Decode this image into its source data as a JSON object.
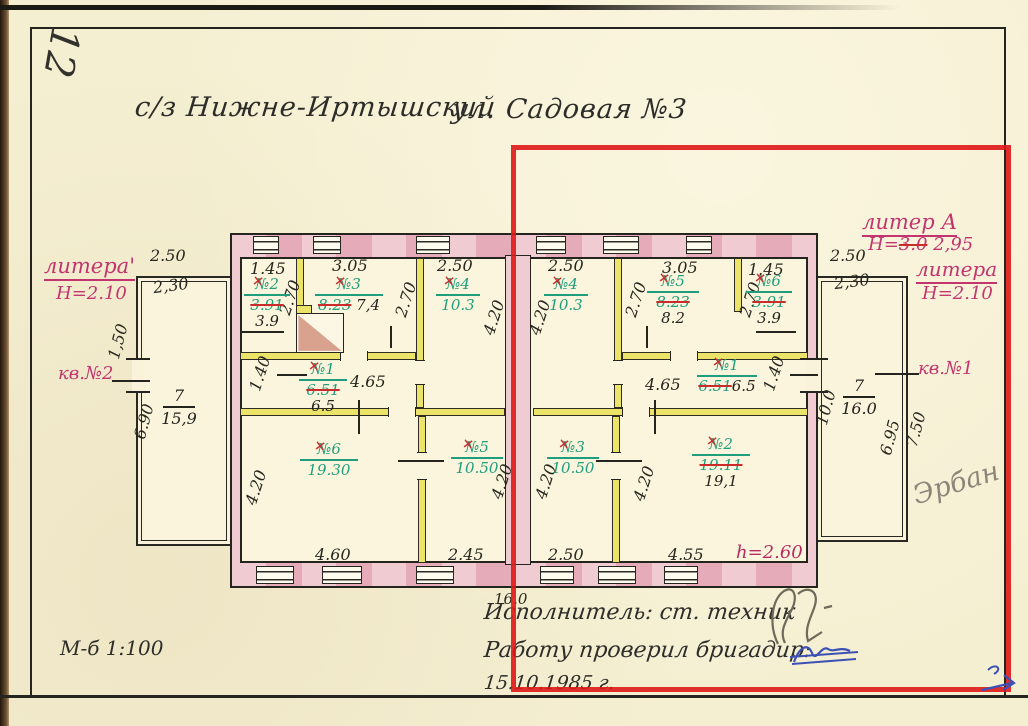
{
  "page": {
    "corner_number": "12",
    "title": "с/з Нижне-Иртышский",
    "title_street": "ул. Садовая №3",
    "scale": "М-б 1:100"
  },
  "left_wing": {
    "litera": "литера'",
    "height": "Н=2.10",
    "apartment": "кв.№2",
    "dim_top": "2.50",
    "dim_top_inner": "2,30",
    "dim_door": "1,50",
    "dim_side": "6.90",
    "room": {
      "no": "7",
      "area": "15,9"
    }
  },
  "right_wing": {
    "liter_a": "литер А",
    "liter_a_h_prefix": "Н=",
    "liter_a_h_old": "3.0",
    "liter_a_h_new": "2,95",
    "litera": "литера",
    "height": "Н=2.10",
    "apartment": "кв.№1",
    "dim_top": "2.50",
    "dim_top_inner": "2,30",
    "dim_side": "10.0",
    "dim_inner": "6.95",
    "dim_outer": "7.50",
    "room": {
      "no": "7",
      "area": "16.0"
    },
    "pencil_note": "Эрбан"
  },
  "building": {
    "dim_total": "16.0",
    "height_note": "h=2.60",
    "top_dims": [
      "1.45",
      "3.05",
      "2.50",
      "2.50",
      "3.05",
      "1.45"
    ],
    "bottom_dims": [
      "4.60",
      "2.45",
      "2.50",
      "4.55"
    ],
    "inner_dims": {
      "d270": "2.70",
      "d420": "4.20",
      "d465": "4.65",
      "d140": "1.40"
    },
    "left_apartment_rooms": [
      {
        "no": "№2",
        "old": "3.91",
        "new": "3.9"
      },
      {
        "no": "№3",
        "old": "8.23",
        "new": "7,4"
      },
      {
        "no": "№4",
        "area": "10.3"
      },
      {
        "no": "№1",
        "old": "6.51",
        "new": "6.5"
      },
      {
        "no": "№6",
        "area": "19.30"
      },
      {
        "no": "№5",
        "area": "10.50"
      }
    ],
    "right_apartment_rooms": [
      {
        "no": "№4",
        "area": "10.3"
      },
      {
        "no": "№5",
        "old": "8.23",
        "new": "8.2"
      },
      {
        "no": "№6",
        "old": "3.91",
        "new": "3.9"
      },
      {
        "no": "№1",
        "old": "6.51",
        "new": "6.5"
      },
      {
        "no": "№3",
        "area": "10.50"
      },
      {
        "no": "№2",
        "old": "19.11",
        "new": "19,1"
      }
    ]
  },
  "footer": {
    "executor": "Исполнитель: ст. техник",
    "checked": "Работу проверил бригадир:",
    "date": "15.10.1985 г."
  },
  "colors": {
    "red_box": "#de1818",
    "green_ink": "#1f9e7d",
    "red_ink": "#cc2b2b",
    "pink_ink": "#c2356f",
    "wall_pink": "#eec6cc",
    "wall_yellow": "#ece468",
    "paper": "#f5efd2"
  }
}
